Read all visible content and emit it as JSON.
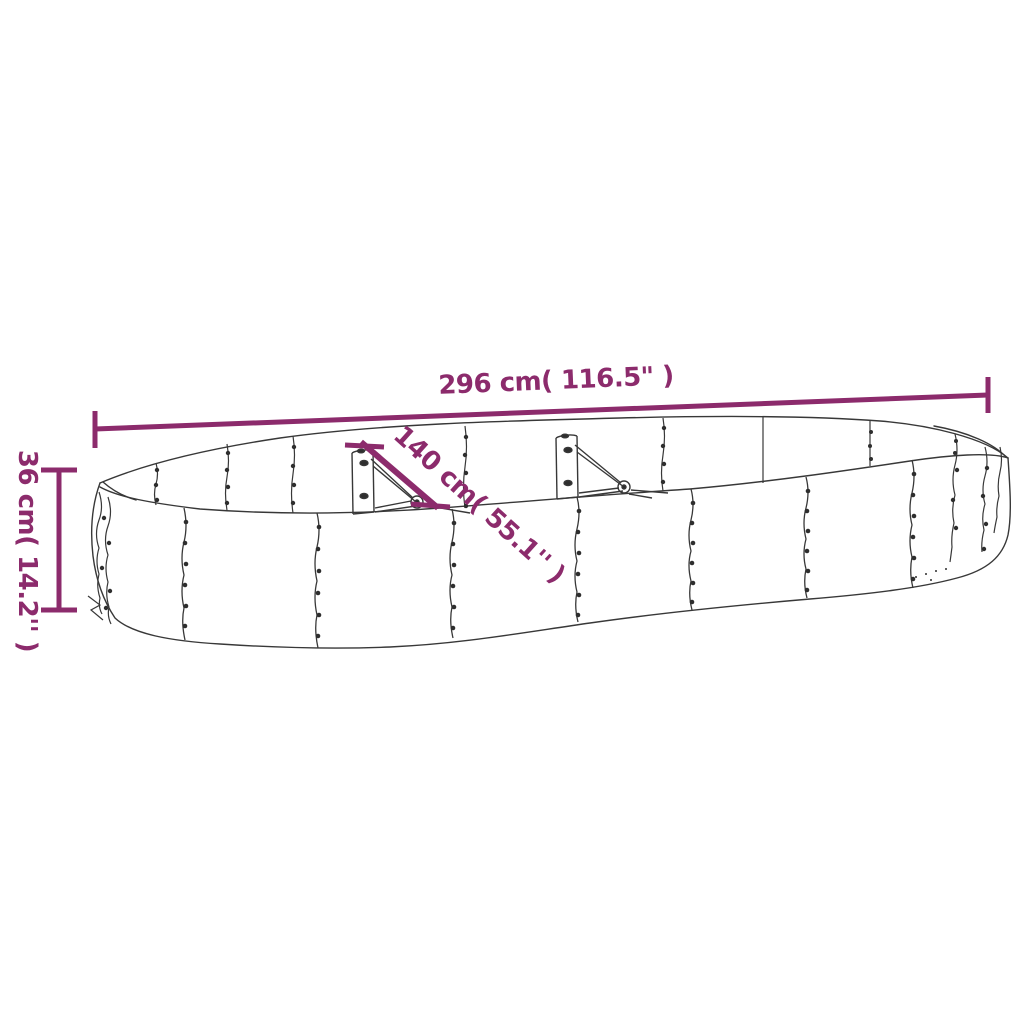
{
  "diagram": {
    "subject": "oval-raised-garden-bed-line-drawing",
    "dimensions": {
      "length": {
        "label": "296 cm( 116.5\" )",
        "value_cm": 296,
        "value_in": 116.5
      },
      "width": {
        "label": "140 cm( 55.1'' )",
        "value_cm": 140,
        "value_in": 55.1
      },
      "height": {
        "label": "36 cm( 14.2'' )",
        "value_cm": 36,
        "value_in": 14.2
      }
    },
    "colors": {
      "dimension_accent": "#8c2b6c",
      "line_art": "#383838",
      "background": "#ffffff"
    }
  }
}
